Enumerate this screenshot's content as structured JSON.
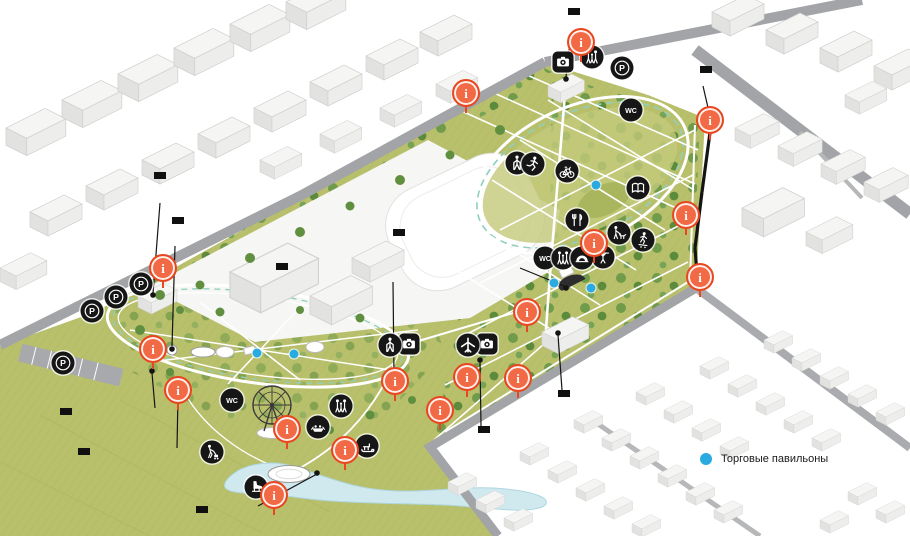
{
  "marker_glyph": "i",
  "colors": {
    "accent_blue": "#29abe2",
    "marker_orange": "#f26a45",
    "label_bg": "#101010"
  },
  "area_labels": [
    {
      "name": "sportcomplex-label",
      "text": "Спорткомплекс",
      "x": 281,
      "y": 208
    },
    {
      "name": "stadium-label",
      "text": "Стадион",
      "x": 452,
      "y": 193
    },
    {
      "name": "school-label",
      "text": "Школа",
      "x": 762,
      "y": 185
    }
  ],
  "callouts": [
    {
      "name": "entrance-sign-callout",
      "text": "Объемные литеры с подсветкой\n«ОТРАДНЫЙ ПАРК»",
      "x": 568,
      "y": 8
    },
    {
      "name": "heating-main-callout",
      "text": "Декорирование теплотрассы",
      "x": 700,
      "y": 66
    },
    {
      "name": "admin-facade-callout",
      "text": "Реконструкция фасадов\nздания администрации",
      "x": 154,
      "y": 172
    },
    {
      "name": "gazebo-callout",
      "text": "Реконструкция\nЛитературной беседки",
      "x": 172,
      "y": 217
    },
    {
      "name": "ferris-wheel-callout",
      "text": "Колесо обозрения Н 36 м",
      "x": 276,
      "y": 263
    },
    {
      "name": "wedding-area-callout",
      "text": "Площадка для свадебных\nцеремоний с деревянными\nскульптурами «Талисманы\nлюбви»",
      "x": 393,
      "y": 229
    },
    {
      "name": "reconciliation-zone-callout",
      "text": "Реконструкция зоны\n«Примирения»",
      "x": 60,
      "y": 408
    },
    {
      "name": "lectory-zone-callout",
      "text": "Реконструкция зоны\nЛектория",
      "x": 78,
      "y": 448
    },
    {
      "name": "pontoon-callout",
      "text": "Деревянный понтон\n- событийная зона",
      "x": 196,
      "y": 506
    },
    {
      "name": "history-zone-callout",
      "text": "Реконструкция зоны истории\nи памяти",
      "x": 478,
      "y": 426
    },
    {
      "name": "utility-block-callout",
      "text": "Реконструкция фасадов\nхозяйственного блока",
      "x": 558,
      "y": 390
    }
  ],
  "icons": [
    {
      "icon": "p",
      "name": "parking-icon",
      "x": 63,
      "y": 363
    },
    {
      "icon": "p",
      "name": "parking-icon",
      "x": 92,
      "y": 311
    },
    {
      "icon": "p",
      "name": "parking-icon",
      "x": 116,
      "y": 297
    },
    {
      "icon": "p",
      "name": "parking-icon",
      "x": 141,
      "y": 284
    },
    {
      "icon": "p",
      "name": "parking-icon",
      "x": 622,
      "y": 68
    },
    {
      "icon": "wc",
      "name": "wc-icon",
      "x": 631,
      "y": 110
    },
    {
      "icon": "wc",
      "name": "wc-icon",
      "x": 545,
      "y": 258
    },
    {
      "icon": "wc",
      "name": "wc-icon",
      "x": 232,
      "y": 400
    },
    {
      "icon": "cam",
      "name": "photo-spot-icon",
      "x": 563,
      "y": 62
    },
    {
      "icon": "cam",
      "name": "photo-spot-icon",
      "x": 409,
      "y": 344
    },
    {
      "icon": "cam",
      "name": "photo-spot-icon",
      "x": 487,
      "y": 344
    },
    {
      "icon": "family",
      "name": "family-zone-icon",
      "x": 592,
      "y": 57
    },
    {
      "icon": "family",
      "name": "family-zone-icon",
      "x": 563,
      "y": 258
    },
    {
      "icon": "family",
      "name": "family-zone-icon",
      "x": 341,
      "y": 406
    },
    {
      "icon": "walk",
      "name": "nordic-walking-icon",
      "x": 517,
      "y": 163
    },
    {
      "icon": "walk",
      "name": "nordic-walking-icon",
      "x": 390,
      "y": 345
    },
    {
      "icon": "run",
      "name": "running-icon",
      "x": 533,
      "y": 164
    },
    {
      "icon": "bike",
      "name": "cycling-icon",
      "x": 567,
      "y": 171
    },
    {
      "icon": "food",
      "name": "food-court-icon",
      "x": 577,
      "y": 220
    },
    {
      "icon": "book",
      "name": "reading-zone-icon",
      "x": 638,
      "y": 188
    },
    {
      "icon": "dog",
      "name": "dog-walking-icon",
      "x": 619,
      "y": 233
    },
    {
      "icon": "skateboard",
      "name": "skatepark-icon",
      "x": 643,
      "y": 240
    },
    {
      "icon": "gym",
      "name": "workout-icon",
      "x": 603,
      "y": 257
    },
    {
      "icon": "stage",
      "name": "stage-icon",
      "x": 582,
      "y": 258
    },
    {
      "icon": "plane",
      "name": "airplane-monument-icon",
      "x": 468,
      "y": 345
    },
    {
      "icon": "boat",
      "name": "boat-station-icon",
      "x": 318,
      "y": 427
    },
    {
      "icon": "sled",
      "name": "sledding-icon",
      "x": 367,
      "y": 446
    },
    {
      "icon": "iceskate",
      "name": "ice-skating-icon",
      "x": 256,
      "y": 487
    },
    {
      "icon": "mower",
      "name": "lawn-care-icon",
      "x": 212,
      "y": 452
    }
  ],
  "info_markers": [
    {
      "x": 581,
      "y": 42
    },
    {
      "x": 466,
      "y": 93
    },
    {
      "x": 710,
      "y": 120
    },
    {
      "x": 686,
      "y": 215
    },
    {
      "x": 700,
      "y": 277
    },
    {
      "x": 594,
      "y": 243
    },
    {
      "x": 527,
      "y": 312
    },
    {
      "x": 163,
      "y": 268
    },
    {
      "x": 153,
      "y": 349
    },
    {
      "x": 178,
      "y": 390
    },
    {
      "x": 395,
      "y": 381
    },
    {
      "x": 467,
      "y": 377
    },
    {
      "x": 518,
      "y": 378
    },
    {
      "x": 440,
      "y": 410
    },
    {
      "x": 287,
      "y": 429
    },
    {
      "x": 345,
      "y": 450
    },
    {
      "x": 274,
      "y": 495
    }
  ],
  "shop_dots": [
    {
      "x": 596,
      "y": 185
    },
    {
      "x": 554,
      "y": 283
    },
    {
      "x": 591,
      "y": 288
    },
    {
      "x": 257,
      "y": 353
    },
    {
      "x": 294,
      "y": 354
    }
  ],
  "pointers": [
    {
      "x1": 570,
      "y1": 42,
      "x2": 566,
      "y2": 77
    },
    {
      "x1": 703,
      "y1": 86,
      "x2": 709,
      "y2": 112
    },
    {
      "x1": 711,
      "y1": 125,
      "x2": 702,
      "y2": 192,
      "w": 3.2
    },
    {
      "x1": 702,
      "y1": 192,
      "x2": 695,
      "y2": 248,
      "w": 3.2
    },
    {
      "x1": 695,
      "y1": 248,
      "x2": 698,
      "y2": 287,
      "w": 3.2
    },
    {
      "x1": 160,
      "y1": 203,
      "x2": 153,
      "y2": 293
    },
    {
      "x1": 175,
      "y1": 246,
      "x2": 172,
      "y2": 346
    },
    {
      "x1": 393,
      "y1": 282,
      "x2": 394,
      "y2": 375
    },
    {
      "x1": 520,
      "y1": 268,
      "x2": 564,
      "y2": 286
    },
    {
      "x1": 155,
      "y1": 408,
      "x2": 152,
      "y2": 373
    },
    {
      "x1": 177,
      "y1": 448,
      "x2": 178,
      "y2": 395
    },
    {
      "x1": 481,
      "y1": 426,
      "x2": 480,
      "y2": 362
    },
    {
      "x1": 562,
      "y1": 390,
      "x2": 558,
      "y2": 335
    },
    {
      "x1": 258,
      "y1": 506,
      "x2": 317,
      "y2": 474
    }
  ],
  "pointer_dots": [
    {
      "x": 566,
      "y": 79
    },
    {
      "x": 153,
      "y": 295
    },
    {
      "x": 172,
      "y": 349
    },
    {
      "x": 152,
      "y": 371
    },
    {
      "x": 566,
      "y": 288
    },
    {
      "x": 480,
      "y": 360
    },
    {
      "x": 558,
      "y": 333
    },
    {
      "x": 317,
      "y": 473
    },
    {
      "x": 698,
      "y": 288
    },
    {
      "x": 711,
      "y": 124
    }
  ],
  "legend": {
    "items": [
      {
        "name": "legend-item-kiosks",
        "label": "Торговые павильоны",
        "color": "#29abe2",
        "x": 700,
        "y": 453
      }
    ]
  }
}
